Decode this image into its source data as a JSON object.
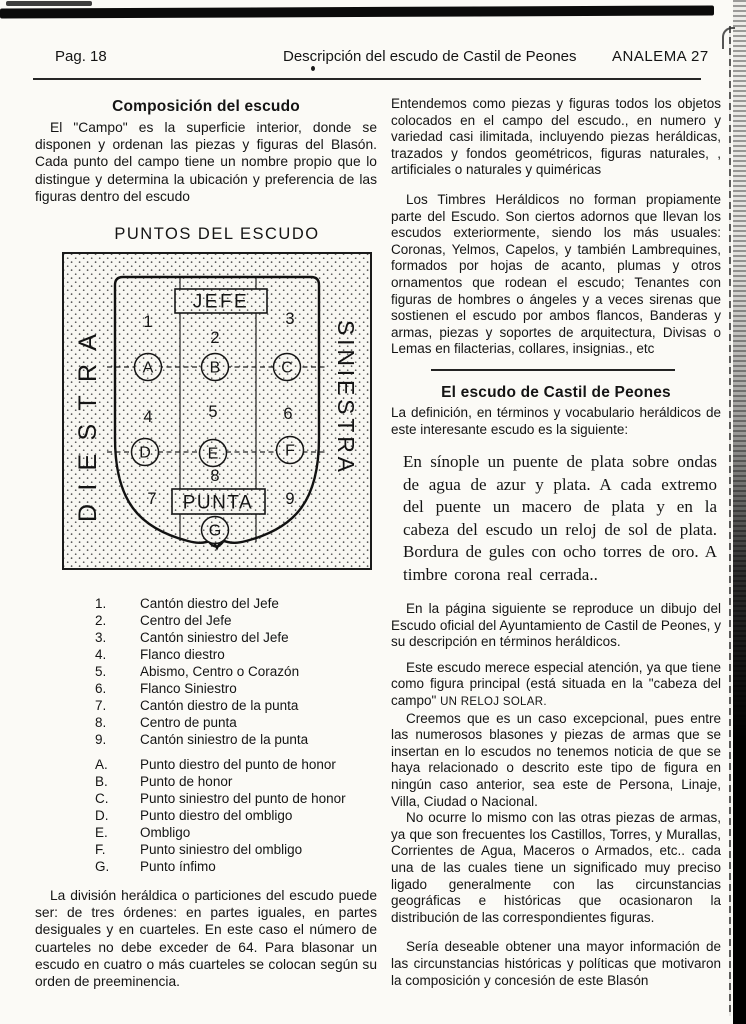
{
  "header": {
    "page_label": "Pag. 18",
    "title": "Descripción del escudo de Castil de Peones",
    "issue": "ANALEMA 27"
  },
  "left_column": {
    "section_title": "Composición del escudo",
    "intro": "El \"Campo\" es la superficie interior, donde se disponen y ordenan las piezas y figuras del Blasón. Cada punto del campo tiene un nombre propio que lo distingue y determina la ubicación y preferencia de las figuras dentro del escudo",
    "diagram": {
      "title": "PUNTOS DEL ESCUDO",
      "jefe_label": "JEFE",
      "punta_label": "PUNTA",
      "left_label": "DIESTRA",
      "right_label": "SINIESTRA",
      "numbers": [
        "1",
        "2",
        "3",
        "4",
        "5",
        "6",
        "7",
        "8",
        "9"
      ],
      "letters": [
        "A",
        "B",
        "C",
        "D",
        "E",
        "F",
        "G"
      ]
    },
    "numbered_list": [
      {
        "marker": "1.",
        "text": "Cantón diestro del Jefe"
      },
      {
        "marker": "2.",
        "text": "Centro del Jefe"
      },
      {
        "marker": "3.",
        "text": "Cantón siniestro del Jefe"
      },
      {
        "marker": "4.",
        "text": "Flanco diestro"
      },
      {
        "marker": "5.",
        "text": "Abismo, Centro o Corazón"
      },
      {
        "marker": "6.",
        "text": "Flanco Siniestro"
      },
      {
        "marker": "7.",
        "text": "Cantón diestro de la punta"
      },
      {
        "marker": "8.",
        "text": "Centro de punta"
      },
      {
        "marker": "9.",
        "text": "Cantón siniestro de la punta"
      }
    ],
    "lettered_list": [
      {
        "marker": "A.",
        "text": "Punto diestro del punto de honor"
      },
      {
        "marker": "B.",
        "text": "Punto de honor"
      },
      {
        "marker": "C.",
        "text": "Punto siniestro del punto de honor"
      },
      {
        "marker": "D.",
        "text": "Punto diestro del ombligo"
      },
      {
        "marker": "E.",
        "text": "Ombligo"
      },
      {
        "marker": "F.",
        "text": "Punto siniestro del ombligo"
      },
      {
        "marker": "G.",
        "text": "Punto ínfimo"
      }
    ],
    "closing": "La división heráldica o particiones del escudo puede ser: de tres órdenes: en partes iguales, en partes desiguales y en cuarteles. En este caso el número de cuarteles no debe exceder de 64. Para blasonar un escudo en cuatro o más cuarteles se colocan según su orden de preeminencia."
  },
  "right_column": {
    "p1": "Entendemos como piezas y figuras todos los objetos colocados en el campo del escudo., en numero y variedad casi ilimitada, incluyendo piezas heráldicas, trazados y fondos geométricos, figuras naturales, , artificiales o naturales y quiméricas",
    "p2": "Los Timbres Heráldicos  no forman propiamente parte del Escudo. Son ciertos adornos que llevan los escudos exteriormente, siendo los más usuales: Coronas, Yelmos, Capelos, y también Lambrequines, formados por hojas de acanto, plumas y otros ornamentos que rodean el escudo; Tenantes con figuras de hombres o ángeles y a veces sirenas que sostienen el escudo por ambos flancos, Banderas y armas, piezas y soportes de arquitectura, Divisas o Lemas en filacterias, collares, insignias., etc",
    "section_title": "El escudo de Castil de Peones",
    "p3": "La definición, en términos y vocabulario heráldicos de este interesante escudo es la siguiente:",
    "blazon": "En sínople un puente de plata sobre ondas de agua de azur y plata. A cada extremo del puente un macero de plata y en la cabeza del escudo un reloj de sol de plata. Bordura de gules con ocho torres de oro. A timbre corona real cerrada..",
    "p4": "En la página siguiente se reproduce un dibujo del Escudo oficial del Ayuntamiento de Castil de Peones, y su descripción en términos heráldicos.",
    "p5_before": "Este escudo merece especial atención, ya que tiene como figura principal (está situada en la \"cabeza del campo\" ",
    "p5_caps": "UN RELOJ SOLAR.",
    "p6": "Creemos que es un caso excepcional, pues entre las numerosos blasones y piezas de armas que se insertan en lo escudos no tenemos noticia de que se haya relacionado o descrito este tipo de figura en ningún caso anterior, sea este de Persona, Linaje, Villa, Ciudad o Nacional.",
    "p7": "No ocurre lo mismo con las otras piezas de armas, ya que son frecuentes los Castillos,  Torres, y Murallas, Corrientes de Agua, Maceros o Armados, etc.. cada una de las cuales tiene un significado muy preciso ligado generalmente con las circunstancias geográficas e históricas que ocasionaron la distribución de las correspondientes figuras.",
    "p8": "Sería deseable obtener una mayor información de las circunstancias históricas y políticas que motivaron la composición y concesión de este Blasón"
  }
}
